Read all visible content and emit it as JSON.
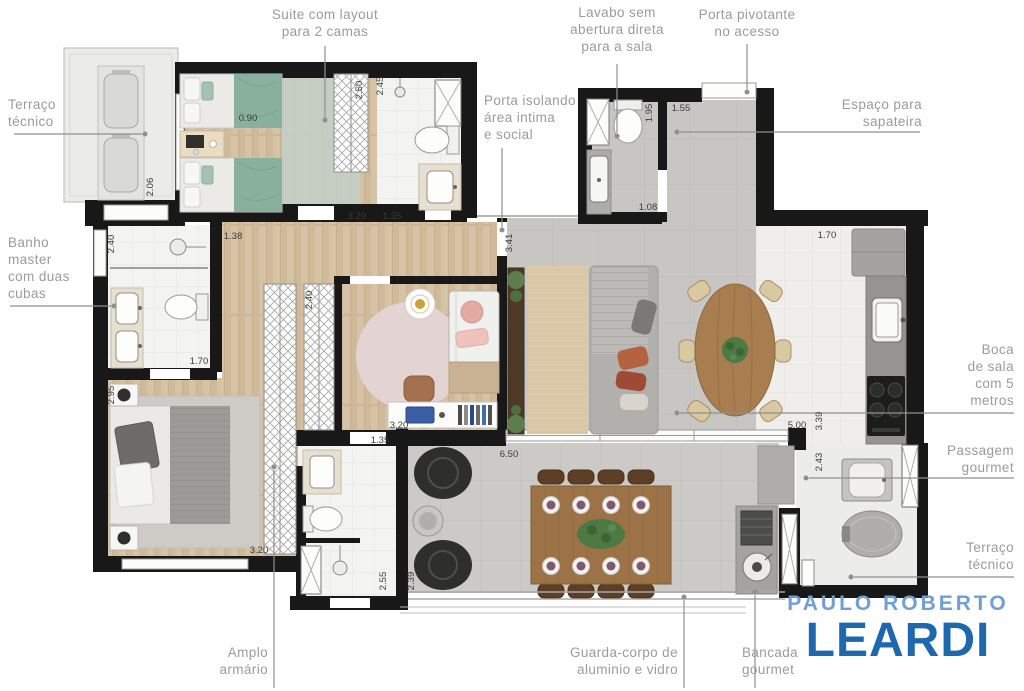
{
  "callouts": {
    "suite_layout": [
      "Suite com layout",
      "para 2 camas"
    ],
    "lavabo": [
      "Lavabo sem",
      "abertura direta",
      "para a sala"
    ],
    "porta_pivotante": [
      "Porta pivotante",
      "no acesso"
    ],
    "terraco_tecnico_left": [
      "Terraço",
      "técnico"
    ],
    "banho_master": [
      "Banho",
      "master",
      "com duas",
      "cubas"
    ],
    "porta_isolando": [
      "Porta isolando",
      "área intima",
      "e social"
    ],
    "sapateira": [
      "Espaço para",
      "sapateira"
    ],
    "boca_de_sala": [
      "Boca",
      "de sala",
      "com 5",
      "metros"
    ],
    "passagem_gourmet": [
      "Passagem",
      "gourmet"
    ],
    "terraco_tecnico_right": [
      "Terraço",
      "técnico"
    ],
    "amplo_armario": [
      "Amplo",
      "armário"
    ],
    "guarda_corpo": [
      "Guarda-corpo de",
      "aluminio e vidro"
    ],
    "bancada_gourmet": [
      "Bancada",
      "gourmet"
    ]
  },
  "dimensions": {
    "terraco_largura": "0.90",
    "terraco_altura": "2.06",
    "suite_closet": "2.50",
    "suite_banho": "2.45",
    "suite_largura": "3.20",
    "suite_banho_largura": "1.35",
    "banho_master_altura": "2.40",
    "hall_largura": "1.38",
    "lavabo_altura": "1.95",
    "acesso_largura": "1.55",
    "lavabo_largura": "1.08",
    "hall_altura": "3.41",
    "acesso_profundidade": "1.70",
    "banho_master_largura": "1.70",
    "dormitorio_altura": "2.95",
    "armario_profundidade": "2.40",
    "quarto_largura": "3.20",
    "quarto_porta": "1.35",
    "sala_largura": "5.00",
    "cozinha_altura": "3.39",
    "cozinha_baixo": "2.43",
    "dormitorio_largura": "3.20",
    "banho2_altura": "2.55",
    "terraco_gourmet_altura": "2.39",
    "terraco_gourmet_largura": "6.50"
  },
  "logo": {
    "line1": "PAULO ROBERTO",
    "line2": "LEARDI",
    "color_line1": "#6f9fd4",
    "color_line2": "#1d68ae"
  },
  "colors": {
    "label_text": "#9b9b9b",
    "dimension_text": "#3c3c3c",
    "wall": "#181818",
    "wood_floor": "#d6c2a4",
    "tile_floor": "#c8c6c2",
    "terrace_floor": "#cccac6",
    "bath_floor": "#f3f3f1",
    "bed_green": "#88b09c",
    "leader_line": "#8f8f8f"
  }
}
